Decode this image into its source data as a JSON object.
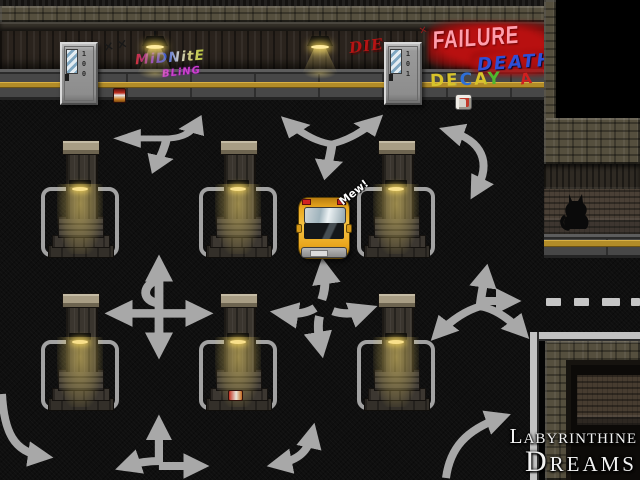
{
  "game": {
    "title": "Labyrinthine Dreams",
    "logo": {
      "line1": "Labyrinthine",
      "line2": "Dreams"
    },
    "speech": {
      "cat_sound": "Mew!"
    },
    "doors": [
      {
        "number": "100"
      },
      {
        "number": "101"
      }
    ],
    "graffiti": {
      "dark_tag": "××",
      "red_tag": "×",
      "midnite_line1": "MiDNitE",
      "midnite_line2": "BLiNG",
      "die": "DIE",
      "failure": "FAILURE",
      "death": "DEATH",
      "decay": "DECAY",
      "decay_suffix": "A F"
    },
    "colors": {
      "road": "#0f0f0f",
      "marking": "#a8a8a8",
      "yellow_line": "#b28c28",
      "taxi": "#eaa71e",
      "glow": "#eed27c",
      "spray_red": "#b81010",
      "failure_text": "#ff9fad",
      "death_blue": "#2f4fd6",
      "logo": "#f2f2f2"
    }
  }
}
